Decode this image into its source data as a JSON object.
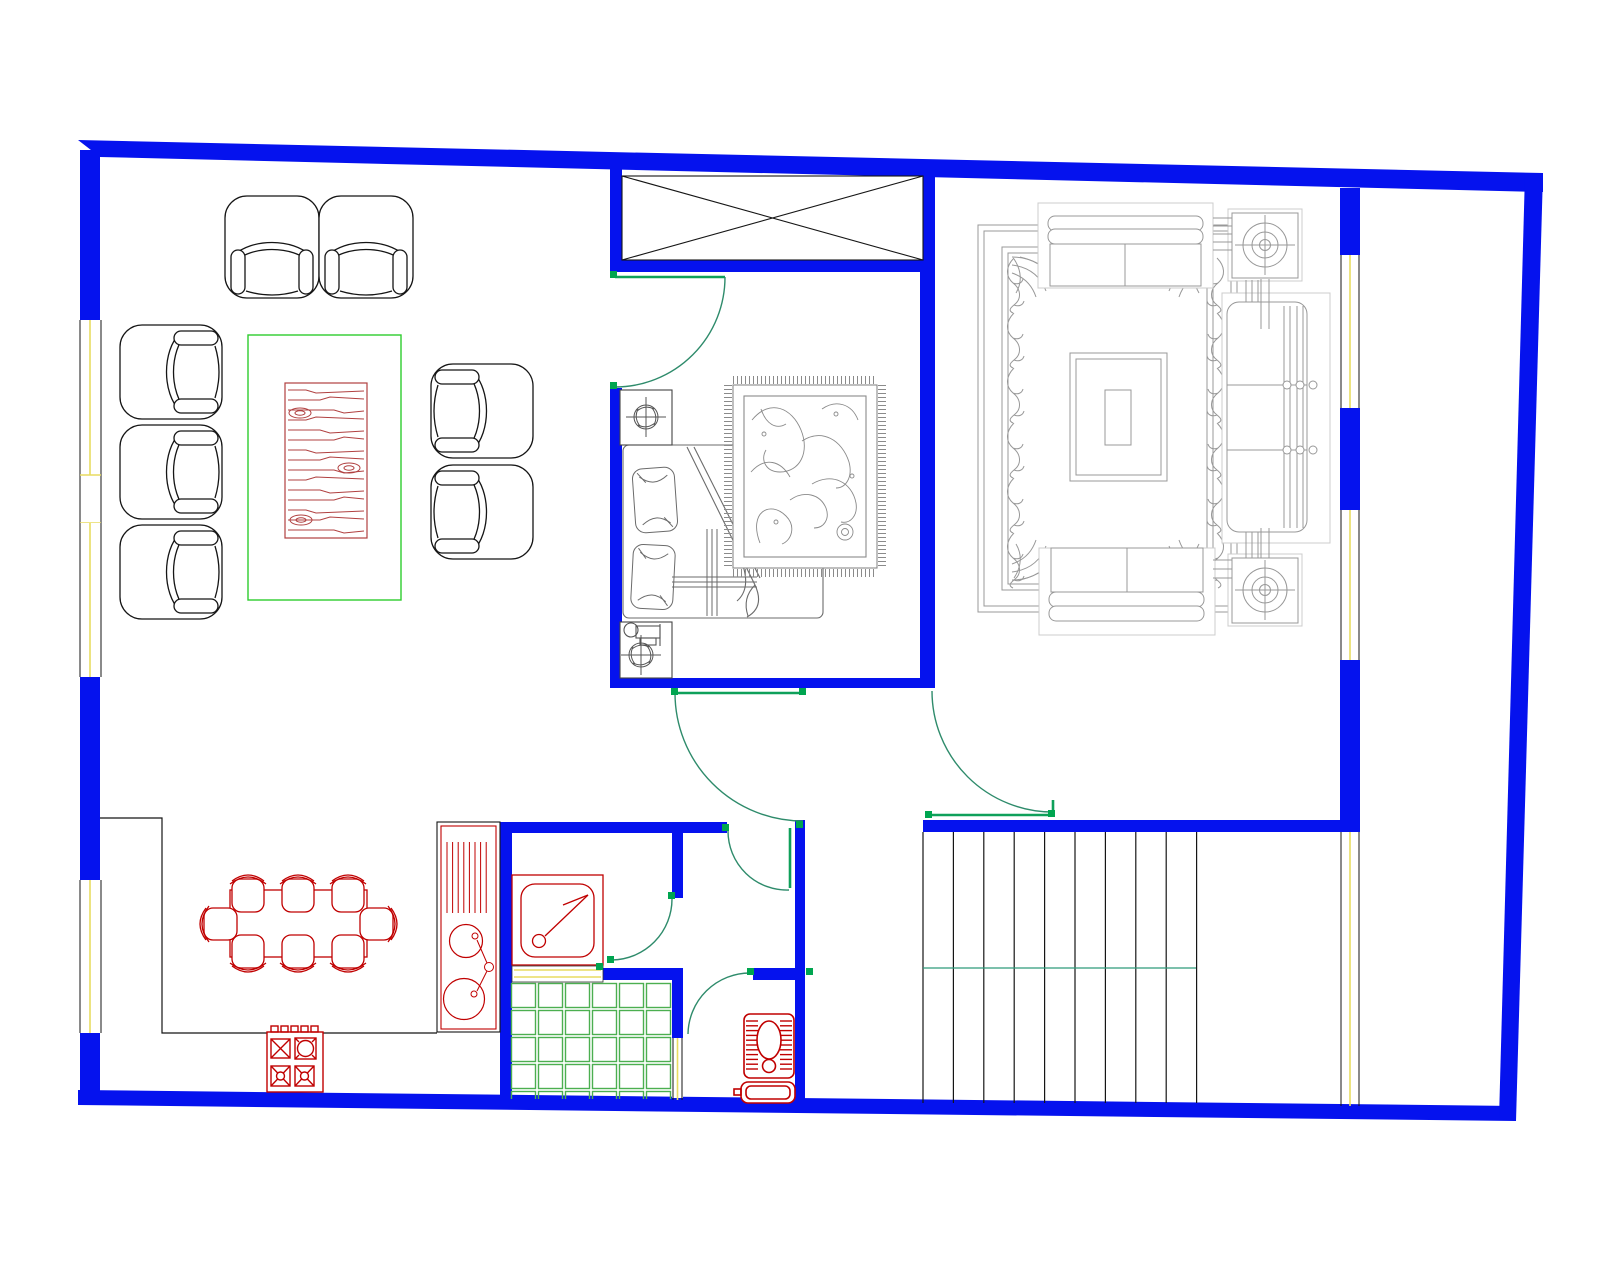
{
  "document": {
    "kind": "architectural-floor-plan",
    "software_style": "CAD line drawing",
    "visible_text": "",
    "background": "#ffffff"
  },
  "palette": {
    "paper": "#ffffff",
    "wall": "#0512ee",
    "ink": "#151515",
    "gray": "#989898",
    "faint": "#cccccc",
    "bedgray": "#6b6b6b",
    "ruggray": "#8a8a8a",
    "red": "#c00000",
    "wood": "#b04040",
    "tablegreen": "#2ecc2e",
    "tilegreen": "#4caf50",
    "arc": "#2e8b6b",
    "leaf": "#0fa05a",
    "tick": "#00a550",
    "glass": "#e8dc60",
    "stairmid": "#2e9b7a"
  },
  "rooms": [
    {
      "name": "lounge",
      "furniture": [
        "two armchairs",
        "three-seat sofa",
        "two armchairs",
        "coffee table with wood-grain top"
      ]
    },
    {
      "name": "bedroom",
      "furniture": [
        "double bed with pillows",
        "two nightstands with fan symbols",
        "patterned rug",
        "closet with cross"
      ]
    },
    {
      "name": "living-room",
      "furniture": [
        "ornate carpet",
        "two sofas",
        "chesterfield sofa",
        "two speaker side-tables",
        "coffee table"
      ]
    },
    {
      "name": "kitchen-dining",
      "furniture": [
        "eight-seat dining table",
        "four-burner stove",
        "counter with double sink"
      ]
    },
    {
      "name": "bathroom",
      "furniture": [
        "shower tray",
        "floor tiles",
        "squat toilet with tank"
      ]
    },
    {
      "name": "staircase",
      "furniture": [
        "straight stair run"
      ]
    }
  ],
  "generated": {
    "linesets": [
      {
        "target": "stairs-lines",
        "dir": "v",
        "x0": 923,
        "y0": 832,
        "dx": 30.4,
        "dy": 0,
        "len": 271,
        "count": 10,
        "stroke": "ink",
        "w": 1.2
      },
      {
        "target": "sink-drain",
        "dir": "v",
        "x0": 447,
        "y0": 842,
        "dx": 5.6,
        "dy": 0,
        "len": 71,
        "count": 8,
        "stroke": "red",
        "w": 1
      },
      {
        "target": "toilet-hatch",
        "dir": "h",
        "x0": 746,
        "y0": 1021,
        "dx": 0,
        "dy": 4.8,
        "len": 12,
        "count": 11,
        "stroke": "red",
        "w": 1.4
      },
      {
        "target": "toilet-hatch",
        "dir": "h",
        "x0": 780,
        "y0": 1021,
        "dx": 0,
        "dy": 4.8,
        "len": 12,
        "count": 11,
        "stroke": "red",
        "w": 1.4
      },
      {
        "target": "lr-connectors",
        "dir": "h",
        "x0": 1213,
        "y0": 218,
        "dx": 0,
        "dy": 8,
        "len": 19,
        "count": 5,
        "stroke": "gray",
        "w": 1
      },
      {
        "target": "lr-connectors",
        "dir": "v",
        "x0": 1261,
        "y0": 279,
        "dx": 8,
        "dy": 0,
        "len": 50,
        "count": 2,
        "stroke": "gray",
        "w": 1
      },
      {
        "target": "lr-connectors",
        "dir": "v",
        "x0": 1261,
        "y0": 528,
        "dx": 8,
        "dy": 0,
        "len": 30,
        "count": 2,
        "stroke": "gray",
        "w": 1
      },
      {
        "target": "lr-connectors",
        "dir": "v",
        "x0": 1246,
        "y0": 280,
        "dx": 6,
        "dy": 0,
        "len": 22,
        "count": 3,
        "stroke": "gray",
        "w": 1
      },
      {
        "target": "lr-connectors",
        "dir": "v",
        "x0": 1246,
        "y0": 532,
        "dx": 6,
        "dy": 0,
        "len": 26,
        "count": 3,
        "stroke": "gray",
        "w": 1
      },
      {
        "target": "lr-connectors",
        "dir": "h",
        "x0": 1213,
        "y0": 560,
        "dx": 0,
        "dy": 9,
        "len": 19,
        "count": 3,
        "stroke": "gray",
        "w": 1
      },
      {
        "target": "bed-bands",
        "dir": "h",
        "x0": 672,
        "y0": 577,
        "dx": 0,
        "dy": 5,
        "len": 85,
        "count": 3,
        "stroke": "bedgray",
        "w": 1
      },
      {
        "target": "bed-bands",
        "dir": "v",
        "x0": 707,
        "y0": 529,
        "dx": 5,
        "dy": 0,
        "len": 87,
        "count": 3,
        "stroke": "bedgray",
        "w": 1
      },
      {
        "target": "shower-curb-lines",
        "dir": "h",
        "x0": 514,
        "y0": 970,
        "dx": 0,
        "dy": 7,
        "len": 87,
        "count": 2,
        "stroke": "glass",
        "w": 1.5
      }
    ],
    "stairs": {
      "step_count": 10,
      "mid_rail_y": 968
    },
    "tiles": {
      "x": 510,
      "y": 982,
      "cols": 6,
      "rows": 5,
      "cell": 27,
      "inset": 1.5,
      "clip_h": 117
    },
    "wood_grain": {
      "x0": 288,
      "x1": 364,
      "y0": 390,
      "dy": 10,
      "lines": 15,
      "knots": [
        [
          300,
          413
        ],
        [
          349,
          468
        ],
        [
          301,
          520
        ]
      ]
    },
    "vines": {
      "left_x": 1008,
      "right_x": 1207,
      "y0": 258,
      "dy": 55,
      "count": 6
    }
  }
}
